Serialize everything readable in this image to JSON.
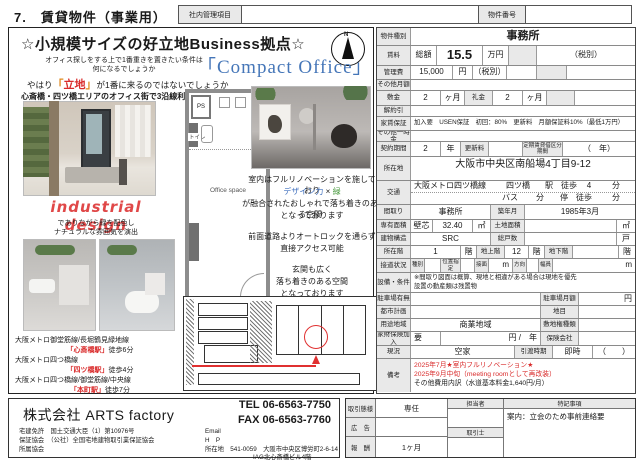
{
  "header": {
    "page_title": "7.　賃貸物件（事業用）",
    "internal_label": "社内管理項目",
    "property_no_label": "物件番号"
  },
  "flyer": {
    "catch_title": "☆小規模サイズの好立地Business拠点☆",
    "compact_office": "「Compact Office」",
    "compass_n": "N",
    "intro1": "オフィス探しをする上で1番重きを置きたい条件は",
    "intro2": "何になるでしょうか",
    "intro3_pre": "やはり",
    "intro3_q1": "「",
    "intro3_loc": "立地",
    "intro3_q2": "」",
    "intro3_post": "が1番に来るのではないでしょうか",
    "area_line": "心斎橋・四ツ橋エリアのオフィス街で3沿線利用可能",
    "industrial": "industrial design",
    "industrial_sub1": "でありながら緑を配色し",
    "industrial_sub2": "ナチュラルな雰囲気を演出",
    "floorplan": {
      "ps": "PS",
      "toilet": "トイレ",
      "office": "Office space"
    },
    "reno1": "室内はフルリノベーションを施しており",
    "reno2a": "デザイン力",
    "reno2b": "×",
    "reno2c": "緑",
    "reno3": "が融合されたおしゃれで落ち着きのある空間",
    "reno4": "となっております",
    "access1": "前面道路よりオートロックを通らず",
    "access2": "直接アクセス可能",
    "entrance1": "玄関も広く",
    "entrance2": "落ち着きのある空間",
    "entrance3": "となっております",
    "stations": [
      {
        "line": "大阪メトロ御堂筋線/長堀鶴見緑地線",
        "station": "「心斎橋駅」",
        "walk": "徒歩6分"
      },
      {
        "line": "大阪メトロ四つ橋線",
        "station": "「四ツ橋駅」",
        "walk": "徒歩4分"
      },
      {
        "line": "大阪メトロ四つ橋線/御堂筋線/中央線",
        "station": "「本町駅」",
        "walk": "徒歩7分"
      }
    ]
  },
  "spec": {
    "type_label": "物件種別",
    "type_value": "事務所",
    "rent_label": "賃料",
    "rent_total_label": "総額",
    "rent_value": "15.5",
    "rent_unit": "万円",
    "rent_tax": "（税別）",
    "mgmt_label": "管理費",
    "mgmt_value": "15,000",
    "mgmt_unit": "円",
    "mgmt_tax": "（税別）",
    "other_monthly_label": "その他月額",
    "deposit_label": "敷金",
    "deposit_value": "2",
    "deposit_unit": "ヶ月",
    "key_label": "礼金",
    "key_value": "2",
    "key_unit": "ヶ月",
    "cancel_label": "解約引",
    "guarantee_label": "家賃保証",
    "guarantee_value": "加入要　USEN保証　初回：80%　更新料　月額保証料10%（最低1万円）",
    "onetime_label": "その他一時金",
    "contract_label": "契約期間",
    "contract_value": "2",
    "contract_unit": "年",
    "renewal_label": "更新料",
    "fixed_label": "定期賃貸借区分期間",
    "fixed_value": "（　年）",
    "address_label": "所在地",
    "address_value": "大阪市中央区南船場4丁目9-12",
    "traffic_label": "交通",
    "traffic_line": "大阪メトロ四ツ橋線",
    "traffic_station": "四ツ橋",
    "traffic_walk_pre": "駅　徒歩",
    "traffic_walk_val": "4",
    "traffic_walk_unit": "分",
    "bus_label": "バス",
    "bus_unit": "分",
    "stop_label": "停　徒歩",
    "stop_unit": "分",
    "layout_label": "間取り",
    "layout_value": "事務所",
    "built_label": "築年月",
    "built_value": "1985年3月",
    "area_label": "専有面積",
    "area_type": "壁芯",
    "area_value": "32.40",
    "area_unit": "㎡",
    "land_label": "土地面積",
    "land_unit": "㎡",
    "struct_label": "建物構造",
    "struct_value": "SRC",
    "units_label": "総戸数",
    "units_unit": "戸",
    "floor_label": "所在階",
    "floor_value": "1",
    "floor_unit": "階",
    "above_label": "地上階",
    "above_value": "12",
    "above_unit": "階",
    "below_label": "地下階",
    "below_unit": "階",
    "road_label": "接道状況",
    "road_type": "種別",
    "road_pos": "位置指定",
    "road_face": "接面",
    "road_m1": "m",
    "road_dir": "方向",
    "road_width": "幅員",
    "road_m2": "m",
    "equip_label": "設備・条件",
    "equip_note1": "※間取り図面は概算、現地と相違がある場合は現地を優先",
    "equip_note2": "設置の動産類は残置物",
    "parking_label": "駐車場有無",
    "parking_fee_label": "駐車場月額",
    "parking_fee_unit": "円",
    "cityplan_label": "都市計画",
    "landcat_label": "地目",
    "zone_label": "用途地域",
    "zone_value": "商業地域",
    "landright_label": "敷地権種類",
    "insurance_label": "家財保険加入",
    "insurance_req": "要",
    "insurance_unit": "円 /　年",
    "insurer_label": "保険会社",
    "status_label": "現況",
    "status_value": "空家",
    "handover_label": "引渡時期",
    "handover_value": "即時",
    "handover_paren": "（　　）",
    "remarks_label": "備考",
    "remarks_red1": "2025年7月★室内フルリノベーション★",
    "remarks_red2": "2025年9月中旬（meeting roomとして再改装）",
    "remarks_black": "その他費用内訳（水道基本料金1,640円/月）"
  },
  "deal": {
    "type_label": "取引態様",
    "type_value": "専任",
    "ad_label": "広　告",
    "fee_label": "報　酬",
    "fee_value": "1ヶ月",
    "staff_label": "担当者",
    "agent_label": "取引士",
    "notes_label": "特記事項",
    "notes_value": "案内：立会のため事前連絡要"
  },
  "footer": {
    "company": "株式会社 ARTS factory",
    "tel_label": "TEL",
    "tel": "06-6563-7750",
    "fax_label": "FAX",
    "fax": "06-6563-7760",
    "license_label": "宅建免許",
    "license": "国土交通大臣（1）第10976号",
    "guarantee_label": "保証協会",
    "guarantee": "（公社）全国宅地建物取引業保証協会",
    "association_label": "所属協会",
    "email_label": "Email",
    "hp_label": "H　P",
    "addr_label": "所在地",
    "addr1": "541-0059　大阪市中央区博労町2-6-14",
    "addr2": "IAG北心斎橋ビル4階"
  }
}
